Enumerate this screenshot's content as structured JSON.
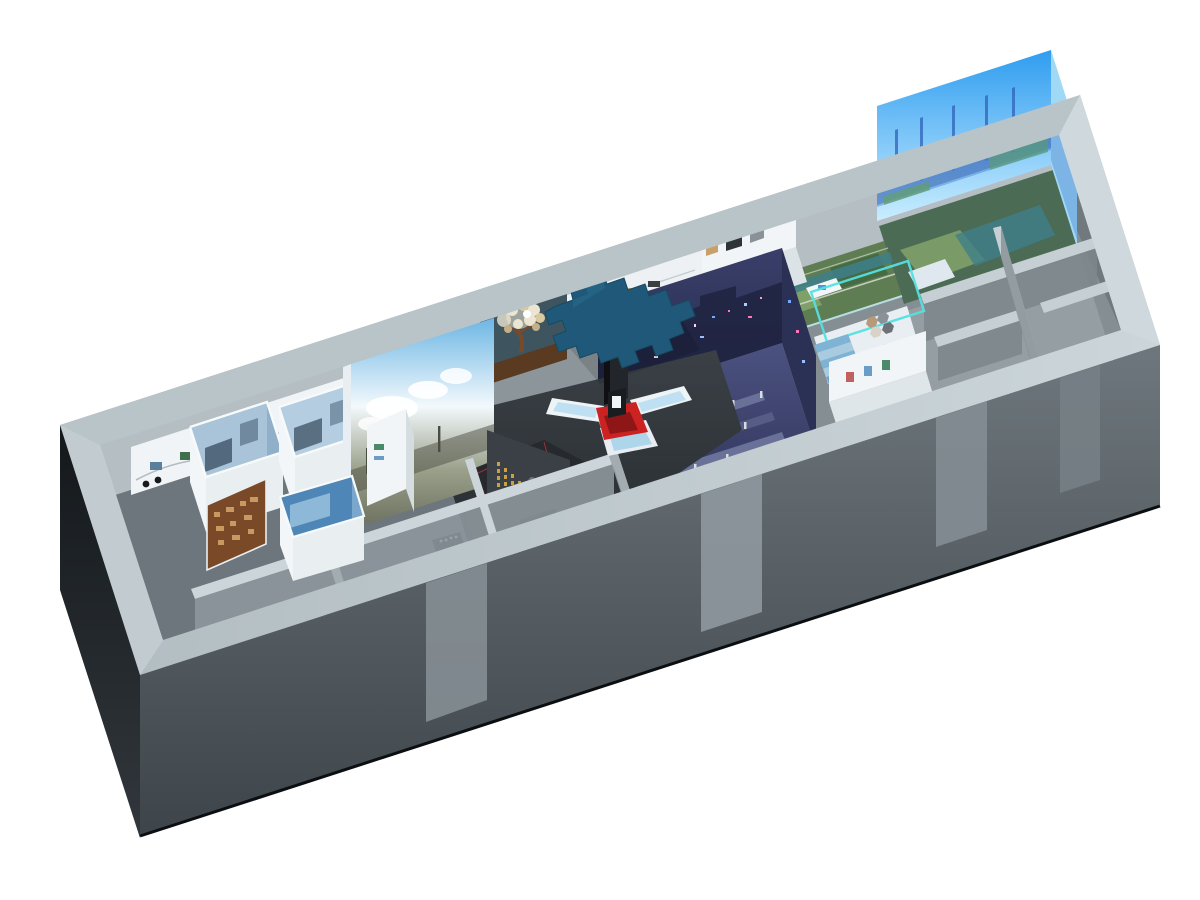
{
  "scene": {
    "name": "exhibition-hall-3d-cutaway",
    "background": "#ffffff"
  },
  "regions": [
    "led-wall-room",
    "sand-table-room",
    "artifact-gallery",
    "central-hall",
    "heritage-tree-wall",
    "floating-map-canopy",
    "interactive-kiosk",
    "timeline-gallery",
    "alcove-photo-exhibits",
    "panorama-cloud-screen",
    "terrain-model",
    "calligraphy-wall",
    "immersive-projection-room",
    "staircase-room",
    "hex-art",
    "poster-room",
    "wood-relic-panel",
    "glacier-box-exhibit",
    "empty-rooms",
    "service-corridor"
  ],
  "colors": {
    "bg": "#ffffff",
    "rim": "#b3bec3",
    "rim_light": "#ccd6da",
    "wall_front_top": "#6e777d",
    "wall_front_bottom": "#3e454a",
    "wall_left_top": "#14181b",
    "wall_left_bottom": "#31373c",
    "wall_right": "#99a2a8",
    "inner_back": "#b4bec3",
    "inner_left": "#d3dce0",
    "inner_right": "#6f797e",
    "floor_base": "#858e93",
    "floor_main": "#8c9599",
    "floor_left": "#6d767c",
    "led_sky_top": "#2f9df0",
    "led_sky_bottom": "#c9edff",
    "led_silhouette": "#3f74c8",
    "sand_green": "#5f7d52",
    "sand_green_light": "#7fa069",
    "sand_teal": "#3e7f8a",
    "gallery_floor": "#dce3e7",
    "white_wall": "#f1f5f7",
    "tree_wall": "#3e545e",
    "tree_ground": "#5b3a22",
    "tree_trunk": "#7a4a28",
    "tree_foliage": "#ebe5d1",
    "canopy": "#1f5878",
    "kiosk_red": "#cc2222",
    "kiosk_screen": "#bfe0f2",
    "kiosk_body": "#eef3f6",
    "cloud_sky": "#6db6e4",
    "cloud_white": "#f3f9fc",
    "cloud_industry": "#9aa08a",
    "cloud_ground": "#6b705f",
    "dark_floor": "#33393e",
    "terrain": "#26292e",
    "terrain_red": "#b23030",
    "gold": "#c9a23f",
    "gold_wall": "#3a4045",
    "imm_wall": "#3a3f6a",
    "imm_wall_dark": "#262a4c",
    "imm_floor": "#4c5280",
    "neon_pink": "#ff77bb",
    "neon_blue": "#77aaff",
    "cyan_trim": "#54e0e0",
    "stair_blue": "#7fb3d4",
    "wood": "#7a4a28",
    "wood_light": "#c89a62",
    "glacier": "#4f86b8",
    "glacier_light": "#9cc4e0",
    "cabinet": "#141619",
    "empty_floor": "#959ea3",
    "wall_top": "#c6d0d4",
    "wall_face": "#7c868b",
    "corridor": "#2f353a"
  }
}
